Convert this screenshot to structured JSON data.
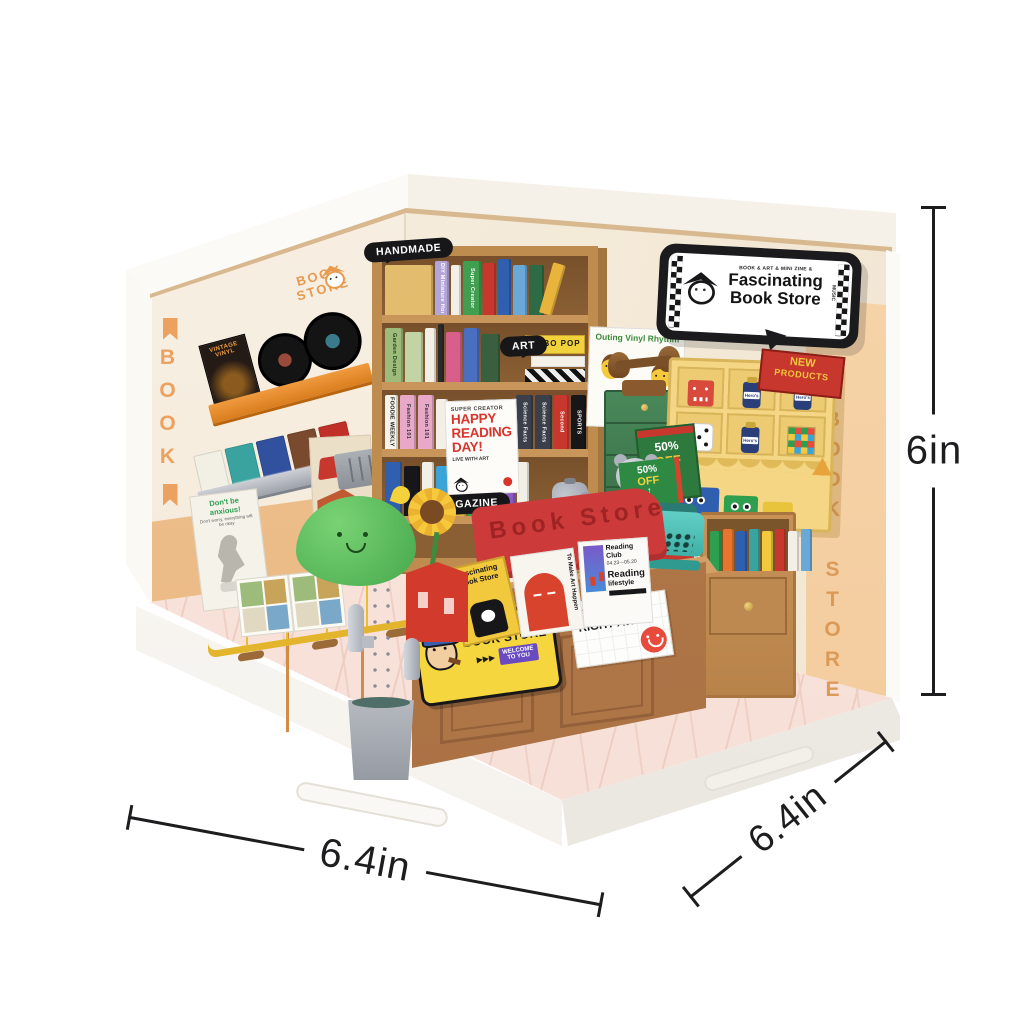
{
  "annotations": {
    "width_front": "6.4in",
    "depth_side": "6.4in",
    "height": "6in"
  },
  "storefront_sign": {
    "tagline": "BOOK & ART & MINI ZINE &",
    "title_line1": "Fascinating",
    "title_line2": "Book Store",
    "side_text": "MUSIC"
  },
  "wall_logo": {
    "line1": "BOOK",
    "line2": "STORE"
  },
  "wall_text": {
    "left_vertical": "BOOK",
    "right_vertical": "BOOK STORE"
  },
  "shelf_bubbles": {
    "top": "HANDMADE",
    "middle": "ART",
    "bottom": "MAGAZINE"
  },
  "posters": {
    "reading": {
      "kicker": "SUPER CREATOR",
      "title_line1": "HAPPY",
      "title_line2": "READING",
      "title_line3": "DAY!",
      "note": "LIVE WITH ART"
    },
    "anxious": {
      "title": "Don't be anxious!",
      "subtitle": "Don't worry, everything will be okay"
    },
    "bread": {
      "title": "Bread Of Spirit"
    },
    "outing": {
      "title": "Outing Vinyl Rhythm"
    },
    "vinyl_album": {
      "title": "VINTAGE VINYL"
    }
  },
  "bookshelf": {
    "bobo_pop": "BOBO POP",
    "rows": [
      {
        "spines": [
          {
            "c": "#e3bd6d",
            "w": 48,
            "h": 50
          },
          {
            "c": "#b5a6da",
            "w": 14,
            "label": "DIY Miniature House",
            "lc": "#ffffff"
          },
          {
            "c": "#f2efe6",
            "w": 10,
            "h": 50
          },
          {
            "c": "#3f9e4f",
            "w": 18,
            "label": "Super Creator",
            "lc": "#ffffff"
          },
          {
            "c": "#c8372e",
            "w": 13,
            "h": 52
          },
          {
            "c": "#2f5fae",
            "w": 13,
            "h": 56
          },
          {
            "c": "#6aa8d8",
            "w": 14,
            "h": 50
          },
          {
            "c": "#2e6b44",
            "w": 15,
            "h": 50
          },
          {
            "c": "#e8b43c",
            "w": 13,
            "h": 52,
            "tilt": 16
          }
        ]
      },
      {
        "spines": [
          {
            "c": "#9dbb7a",
            "w": 18,
            "label": "Garden Design",
            "lc": "#23421f"
          },
          {
            "c": "#c2d4a4",
            "w": 18,
            "h": 50
          },
          {
            "c": "#f2efe6",
            "w": 11
          },
          {
            "c": "#2a2a2a",
            "w": 6,
            "h": 58
          },
          {
            "c": "#d85f8a",
            "w": 16,
            "h": 50
          },
          {
            "c": "#4a6fc0",
            "w": 15
          },
          {
            "c": "#3a5f3f",
            "w": 19,
            "h": 48
          }
        ]
      },
      {
        "spines": [
          {
            "c": "#f6f3ea",
            "w": 13,
            "label": "FOODIE WEEKLY",
            "lc": "#111111"
          },
          {
            "c": "#e8a8c8",
            "w": 16,
            "label": "Fashion 101",
            "lc": "#333333"
          },
          {
            "c": "#e8a8c8",
            "w": 16,
            "label": "Fashion 101",
            "lc": "#333333"
          },
          {
            "c": "#f2efe6",
            "w": 12,
            "h": 50
          }
        ]
      },
      {
        "spines": [
          {
            "c": "#2f5fae",
            "w": 17
          },
          {
            "c": "#17171a",
            "w": 16,
            "h": 50
          },
          {
            "c": "#f2efe6",
            "w": 12
          },
          {
            "c": "#3aa3d8",
            "w": 15,
            "h": 50
          },
          {
            "c": "#e8b43c",
            "w": 13
          },
          {
            "c": "#2e9e4f",
            "w": 15,
            "h": 52
          },
          {
            "c": "#c8372e",
            "w": 14
          },
          {
            "c": "#8a5ac0",
            "w": 14,
            "h": 50
          },
          {
            "c": "#f2efe6",
            "w": 12
          }
        ]
      }
    ],
    "row3_right": [
      {
        "c": "#e85a3c",
        "w": 9,
        "h": 44
      },
      {
        "c": "#3aa3d8",
        "w": 9,
        "h": 46
      },
      {
        "c": "#f2c83c",
        "w": 9,
        "h": 44
      },
      {
        "c": "#7a4ac0",
        "w": 9,
        "h": 46
      },
      {
        "c": "#2e9e4f",
        "w": 9,
        "h": 44
      },
      {
        "c": "#c03028",
        "w": 9,
        "h": 46
      },
      {
        "c": "#3a3f4a",
        "w": 17,
        "label": "Science Facts",
        "lc": "#ffffff"
      },
      {
        "c": "#3a3f4a",
        "w": 17,
        "label": "Science Facts",
        "lc": "#ffffff"
      },
      {
        "c": "#c8372e",
        "w": 15,
        "label": "Second",
        "lc": "#ffffff"
      },
      {
        "c": "#17171a",
        "w": 15,
        "label": "SPORTS",
        "lc": "#ffffff"
      }
    ]
  },
  "right_cabinet": {
    "spines": [
      {
        "c": "#2e9e4f",
        "w": 11,
        "h": 40
      },
      {
        "c": "#e8742e",
        "w": 11,
        "h": 42
      },
      {
        "c": "#2f5fae",
        "w": 11,
        "h": 40
      },
      {
        "c": "#3aa3a0",
        "w": 11,
        "h": 42
      },
      {
        "c": "#f2c83c",
        "w": 11,
        "h": 40
      },
      {
        "c": "#c8372e",
        "w": 11,
        "h": 42
      },
      {
        "c": "#f2efe6",
        "w": 11,
        "h": 40
      },
      {
        "c": "#6aa8d8",
        "w": 11,
        "h": 42
      }
    ]
  },
  "magazine_rack": {
    "covers": [
      "#f2efe4",
      "#3aa3a0",
      "#31519e",
      "#7a4a2e",
      "#c03028"
    ]
  },
  "display_stand": {
    "header": "Book Store",
    "books": [
      {
        "title_line1": "Fascinating",
        "title_line2": "Book Store"
      },
      {
        "title": "To Make Art Happen"
      },
      {
        "title": "Reading Club",
        "date": "04.23—05.20",
        "sub1": "Reading",
        "sub2": "lifestyle"
      }
    ]
  },
  "counter_sign": {
    "line1": "ARTISTS",
    "line2": "BOOK STORE",
    "badge_line1": "WELCOME",
    "badge_line2": "TO YOU",
    "arrows": "▶▶▶"
  },
  "promo_card": {
    "line1": "GET IT",
    "line2": "RIGHT AWAY!"
  },
  "new_cabinet": {
    "plate_line1": "NEW",
    "plate_line2": "PRODUCTS",
    "ink_label": "Hero's"
  },
  "discount": {
    "percent": "50%",
    "off": "OFF",
    "arrow": "↑"
  },
  "colors": {
    "accent_orange": "#e9862c",
    "wood": "#b98a50",
    "wall_cream": "#f5ecdd",
    "floor_pink": "#f8e3dc",
    "sign_black": "#1d1d1f",
    "display_red": "#cc3a3a",
    "bench_yellow": "#f6d244",
    "cabinet_yellow": "#f2d580",
    "cabinet_green": "#3f7d4e"
  }
}
